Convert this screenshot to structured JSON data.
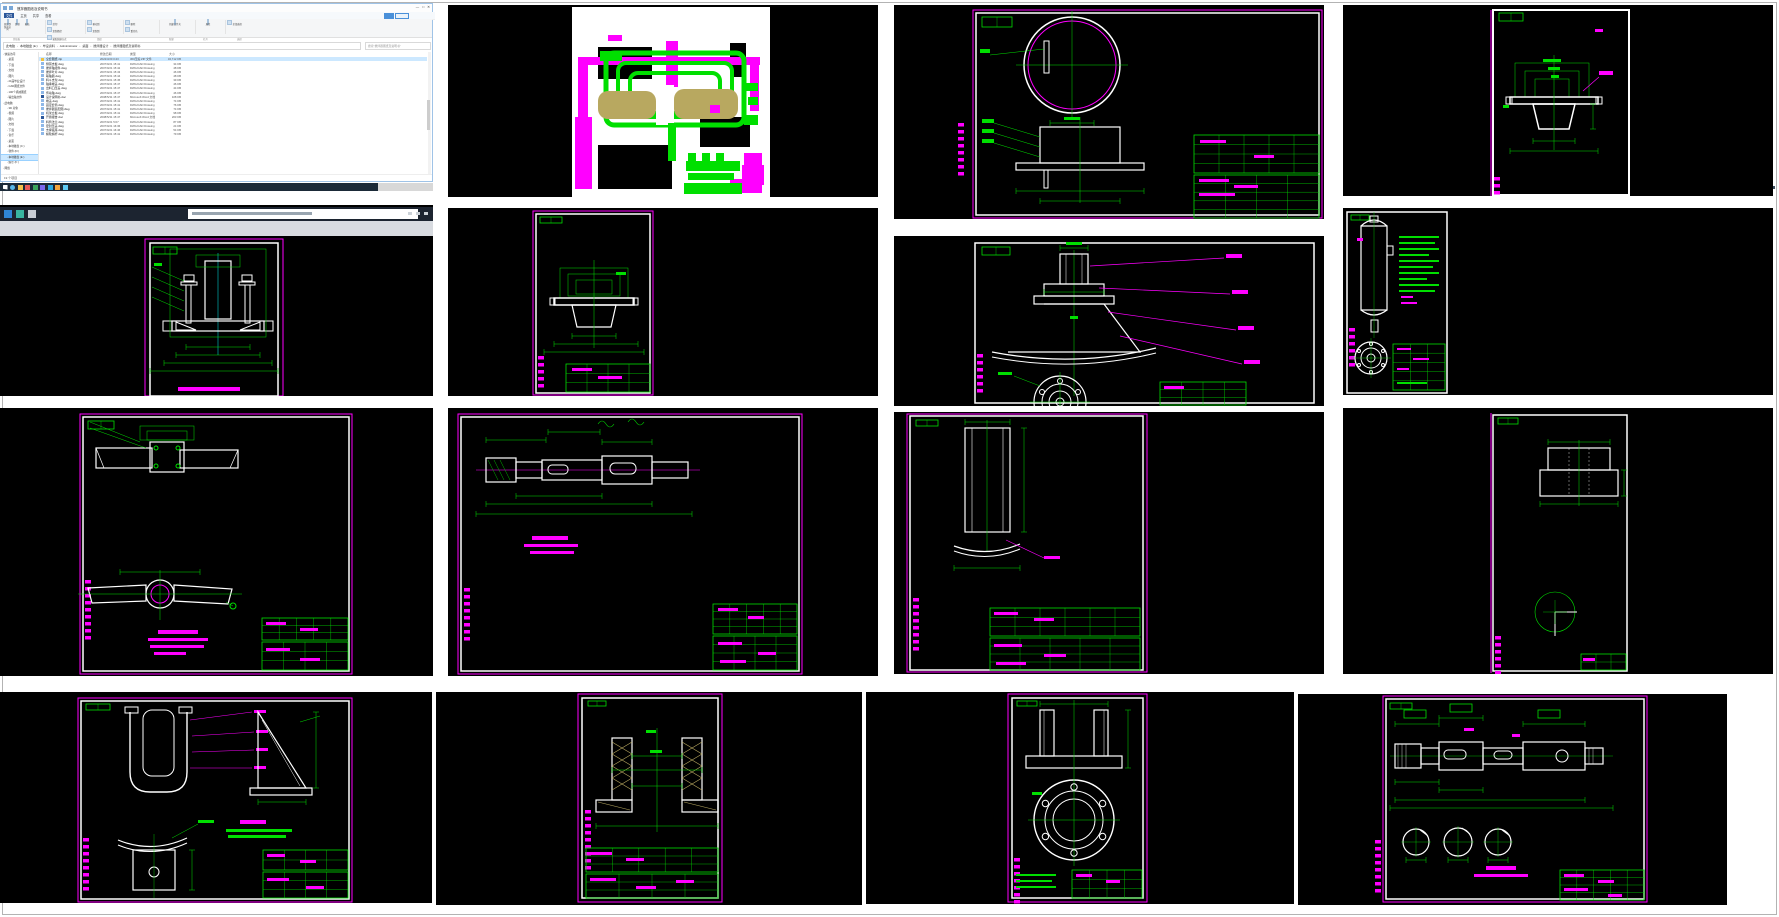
{
  "page": {
    "background": "#ffffff",
    "border_color": "#b3b3b3"
  },
  "cad_colors": {
    "background": "#000000",
    "frame_magenta": "#FF00FF",
    "dimension_green": "#00DF00",
    "geometry_white": "#FFFFFF",
    "hatch_khaki": "#B8A860",
    "centerline_cyan": "#00CCCC"
  },
  "explorer": {
    "title": "搅拌器图纸及说明书",
    "window_controls": [
      "—",
      "□",
      "✕"
    ],
    "tabs": [
      "文件",
      "主页",
      "共享",
      "查看"
    ],
    "ribbon_buttons": [
      "固定到快速访问",
      "复制",
      "粘贴",
      "剪切",
      "复制路径",
      "粘贴快捷方式",
      "移动到",
      "复制到",
      "删除",
      "重命名",
      "新建文件夹",
      "属性",
      "全部选择"
    ],
    "ribbon_groups": [
      "剪贴板",
      "组织",
      "新建",
      "打开",
      "选择"
    ],
    "address_segments": [
      "此电脑",
      "本地磁盘 (E:)",
      "毕设资料",
      "Administrator",
      "桌面",
      "搅拌器设计",
      "搅拌器图纸及说明书"
    ],
    "search_placeholder": "搜索\"搅拌器图纸及说明书\"",
    "columns": [
      "名称",
      "修改日期",
      "类型",
      "大小"
    ],
    "files": [
      {
        "name": "全套图纸.zip",
        "date": "2022/3/20 0:43",
        "type": "360压缩 ZIP 文件",
        "size": "32,712 KB",
        "icon": "#f0c040",
        "selected": true
      },
      {
        "name": "侧耳支板.dwg",
        "date": "2007/9/21 15:41",
        "type": "DWG/CAD Drawing",
        "size": "34 KB",
        "icon": "#8fb8e8"
      },
      {
        "name": "搅拌轴组件.dwg",
        "date": "2007/9/21 15:42",
        "type": "DWG/CAD Drawing",
        "size": "48 KB",
        "icon": "#8fb8e8"
      },
      {
        "name": "搅拌叶片.dwg",
        "date": "2007/9/21 15:43",
        "type": "DWG/CAD Drawing",
        "size": "46 KB",
        "icon": "#8fb8e8"
      },
      {
        "name": "联轴器.dwg",
        "date": "2007/9/21 15:44",
        "type": "DWG/CAD Drawing",
        "size": "48 KB",
        "icon": "#8fb8e8"
      },
      {
        "name": "料斗支架.dwg",
        "date": "2007/9/21 15:45",
        "type": "DWG/CAD Drawing",
        "size": "39 KB",
        "icon": "#8fb8e8"
      },
      {
        "name": "轴承端盖.dwg",
        "date": "2007/9/21 15:47",
        "type": "DWG/CAD Drawing",
        "size": "46 KB",
        "icon": "#8fb8e8"
      },
      {
        "name": "出料口压盖.dwg",
        "date": "2007/9/21 15:47",
        "type": "DWG/CAD Drawing",
        "size": "44 KB",
        "icon": "#8fb8e8"
      },
      {
        "name": "传动轴.dwg",
        "date": "2007/9/21 15:47",
        "type": "DWG/CAD Drawing",
        "size": "46 KB",
        "icon": "#8fb8e8"
      },
      {
        "name": "设计说明书.doc",
        "date": "2008/5/31 15:47",
        "type": "Microsoft Word 文档",
        "size": "108 KB",
        "icon": "#2b579a"
      },
      {
        "name": "端盖.dwg",
        "date": "2007/9/21 15:41",
        "type": "DWG/CAD Drawing",
        "size": "74 KB",
        "icon": "#8fb8e8"
      },
      {
        "name": "固定套筒.dwg",
        "date": "2007/9/21 15:41",
        "type": "DWG/CAD Drawing",
        "size": "76 KB",
        "icon": "#8fb8e8"
      },
      {
        "name": "搅拌器装配图.dwg",
        "date": "2007/9/21 15:41",
        "type": "DWG/CAD Drawing",
        "size": "74 KB",
        "icon": "#8fb8e8"
      },
      {
        "name": "机架立板.dwg",
        "date": "2007/9/21 15:41",
        "type": "DWG/CAD Drawing",
        "size": "98 KB",
        "icon": "#8fb8e8"
      },
      {
        "name": "开题报告.doc",
        "date": "2008/5/31 15:47",
        "type": "Microsoft Word 文档",
        "size": "203 KB",
        "icon": "#2b579a"
      },
      {
        "name": "料筒法兰.dwg",
        "date": "2007/9/21 5:07",
        "type": "DWG/CAD Drawing",
        "size": "87 KB",
        "icon": "#8fb8e8"
      },
      {
        "name": "密封压盖.dwg",
        "date": "2007/9/21 16:36",
        "type": "DWG/CAD Drawing",
        "size": "24 KB",
        "icon": "#8fb8e8"
      },
      {
        "name": "支撑底座.dwg",
        "date": "2007/9/21 16:46",
        "type": "DWG/CAD Drawing",
        "size": "54 KB",
        "icon": "#8fb8e8"
      },
      {
        "name": "蜗轮蜗杆.dwg",
        "date": "2007/9/21 15:41",
        "type": "DWG/CAD Drawing",
        "size": "79 KB",
        "icon": "#8fb8e8"
      }
    ],
    "nav": [
      {
        "label": "快速访问",
        "level": 0
      },
      {
        "label": "桌面",
        "level": 1
      },
      {
        "label": "下载",
        "level": 1
      },
      {
        "label": "文档",
        "level": 1
      },
      {
        "label": "图片",
        "level": 1
      },
      {
        "label": "21届毕业设计",
        "level": 1
      },
      {
        "label": "CAD图纸文件",
        "level": 1
      },
      {
        "label": "100个机械图纸",
        "level": 1
      },
      {
        "label": "输出轴文件",
        "level": 1
      },
      {
        "label": "此电脑",
        "level": 0
      },
      {
        "label": "3D 对象",
        "level": 1
      },
      {
        "label": "视频",
        "level": 1
      },
      {
        "label": "图片",
        "level": 1
      },
      {
        "label": "文档",
        "level": 1
      },
      {
        "label": "下载",
        "level": 1
      },
      {
        "label": "音乐",
        "level": 1
      },
      {
        "label": "桌面",
        "level": 1
      },
      {
        "label": "本地磁盘 (C:)",
        "level": 1
      },
      {
        "label": "软件 (D:)",
        "level": 1
      },
      {
        "label": "本地磁盘 (E:)",
        "level": 1,
        "selected": true
      },
      {
        "label": "娱乐 (F:)",
        "level": 1
      },
      {
        "label": "网络",
        "level": 0
      }
    ],
    "status": "19 个项目",
    "taskbar_icon_colors": [
      "#ffffff",
      "#58b7e8",
      "#f2c14e",
      "#e85959",
      "#3ba55c",
      "#7b68ee",
      "#29a8e0",
      "#f2a33c",
      "#5cc9f5"
    ]
  },
  "tiles": [
    {
      "name": "dwg-thumbnail-preview"
    },
    {
      "name": "lid-with-slot-flange-drawing"
    },
    {
      "name": "flange-cover-drawing"
    },
    {
      "name": "clamp-assembly-drawing"
    },
    {
      "name": "flange-bush-drawing"
    },
    {
      "name": "hopper-cone-drawing"
    },
    {
      "name": "pressure-vessel-drawing"
    },
    {
      "name": "agitator-propeller-drawing"
    },
    {
      "name": "stepped-shaft-drawing"
    },
    {
      "name": "guide-plate-drawing"
    },
    {
      "name": "coupling-drawing"
    },
    {
      "name": "bracket-gusset-drawing"
    },
    {
      "name": "lined-bushing-drawing"
    },
    {
      "name": "bolted-flange-drawing"
    },
    {
      "name": "output-shaft-drawing"
    }
  ]
}
